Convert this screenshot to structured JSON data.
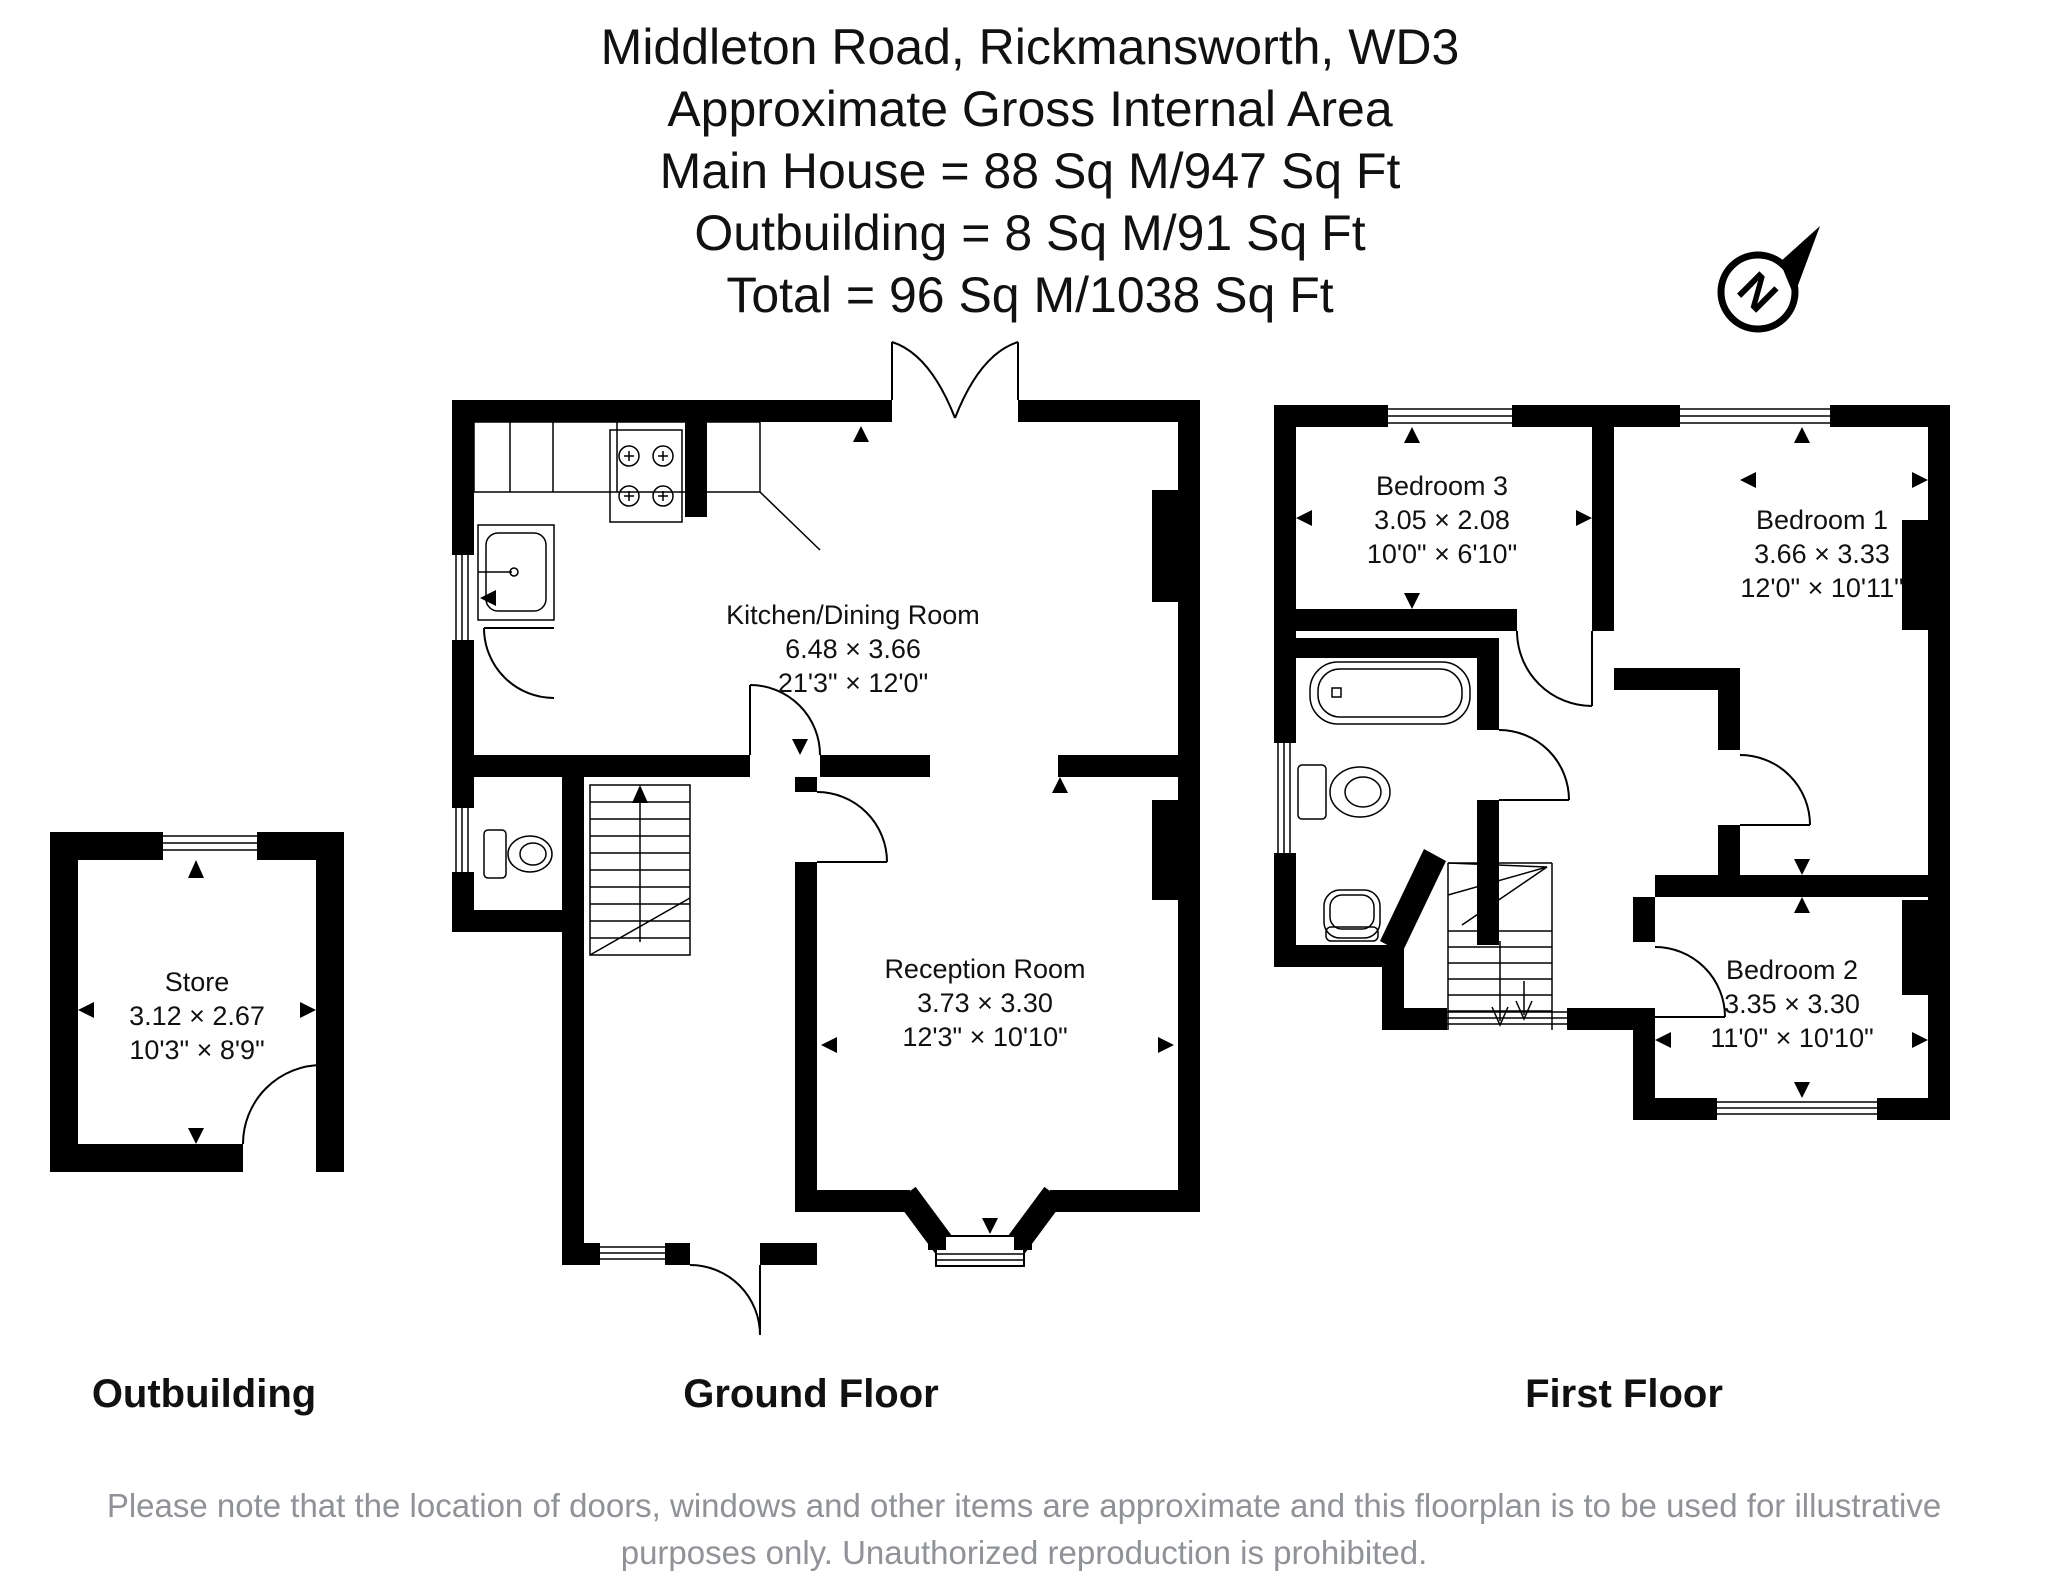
{
  "title": {
    "lines": [
      "Middleton Road, Rickmansworth, WD3",
      "Approximate Gross Internal Area",
      "Main House = 88 Sq M/947 Sq Ft",
      "Outbuilding = 8 Sq M/91 Sq Ft",
      "Total = 96 Sq M/1038 Sq Ft"
    ]
  },
  "compass": {
    "label": "N"
  },
  "plans": {
    "outbuilding": {
      "caption": "Outbuilding",
      "rooms": {
        "store": {
          "name": "Store",
          "metric": "3.12 × 2.67",
          "imperial": "10'3\" × 8'9\""
        }
      }
    },
    "ground": {
      "caption": "Ground Floor",
      "rooms": {
        "kitchen": {
          "name": "Kitchen/Dining Room",
          "metric": "6.48 × 3.66",
          "imperial": "21'3\" × 12'0\""
        },
        "reception": {
          "name": "Reception Room",
          "metric": "3.73 × 3.30",
          "imperial": "12'3\" × 10'10\""
        }
      }
    },
    "first": {
      "caption": "First Floor",
      "rooms": {
        "bedroom3": {
          "name": "Bedroom 3",
          "metric": "3.05 × 2.08",
          "imperial": "10'0\" × 6'10\""
        },
        "bedroom1": {
          "name": "Bedroom 1",
          "metric": "3.66 × 3.33",
          "imperial": "12'0\" × 10'11\""
        },
        "bedroom2": {
          "name": "Bedroom 2",
          "metric": "3.35 × 3.30",
          "imperial": "11'0\" × 10'10\""
        }
      }
    }
  },
  "disclaimer": {
    "lines": [
      "Please note that the location of doors, windows and other items are approximate and this floorplan is to be used for illustrative",
      "purposes only. Unauthorized reproduction is prohibited."
    ]
  },
  "colors": {
    "wall": "#000000",
    "text": "#111111",
    "disclaimer": "#8f9296"
  }
}
